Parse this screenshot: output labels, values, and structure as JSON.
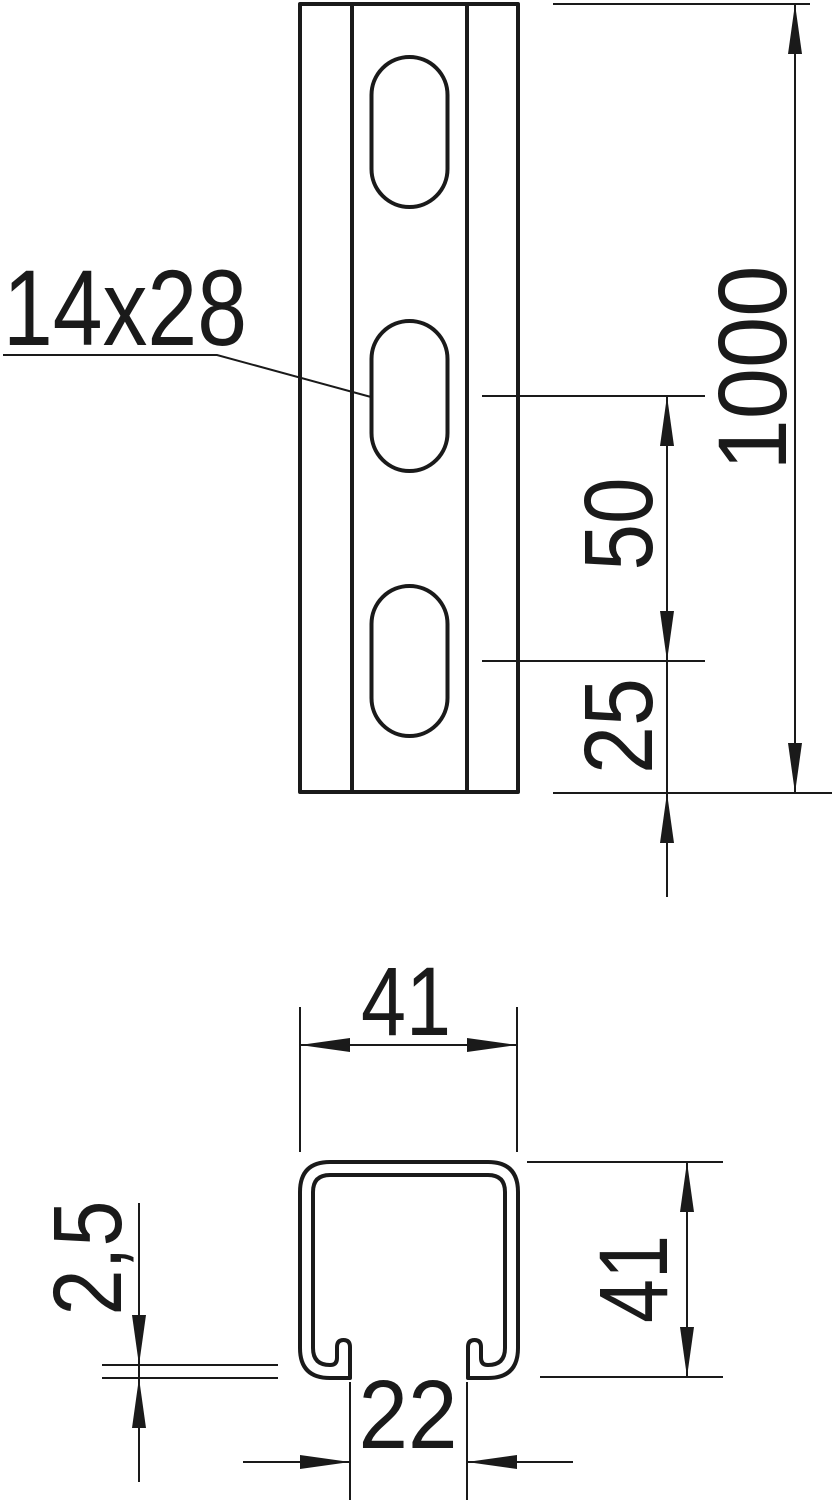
{
  "front_view": {
    "slot_size_label": "14x28",
    "overall_length_dim": "1000",
    "slot_pitch_dim": "50",
    "end_distance_dim": "25"
  },
  "cross_section": {
    "outer_width_dim": "41",
    "outer_height_dim": "41",
    "material_thickness_dim": "2,5",
    "slot_opening_dim": "22"
  },
  "colors": {
    "line": "#1a1a1a",
    "background": "#ffffff"
  }
}
